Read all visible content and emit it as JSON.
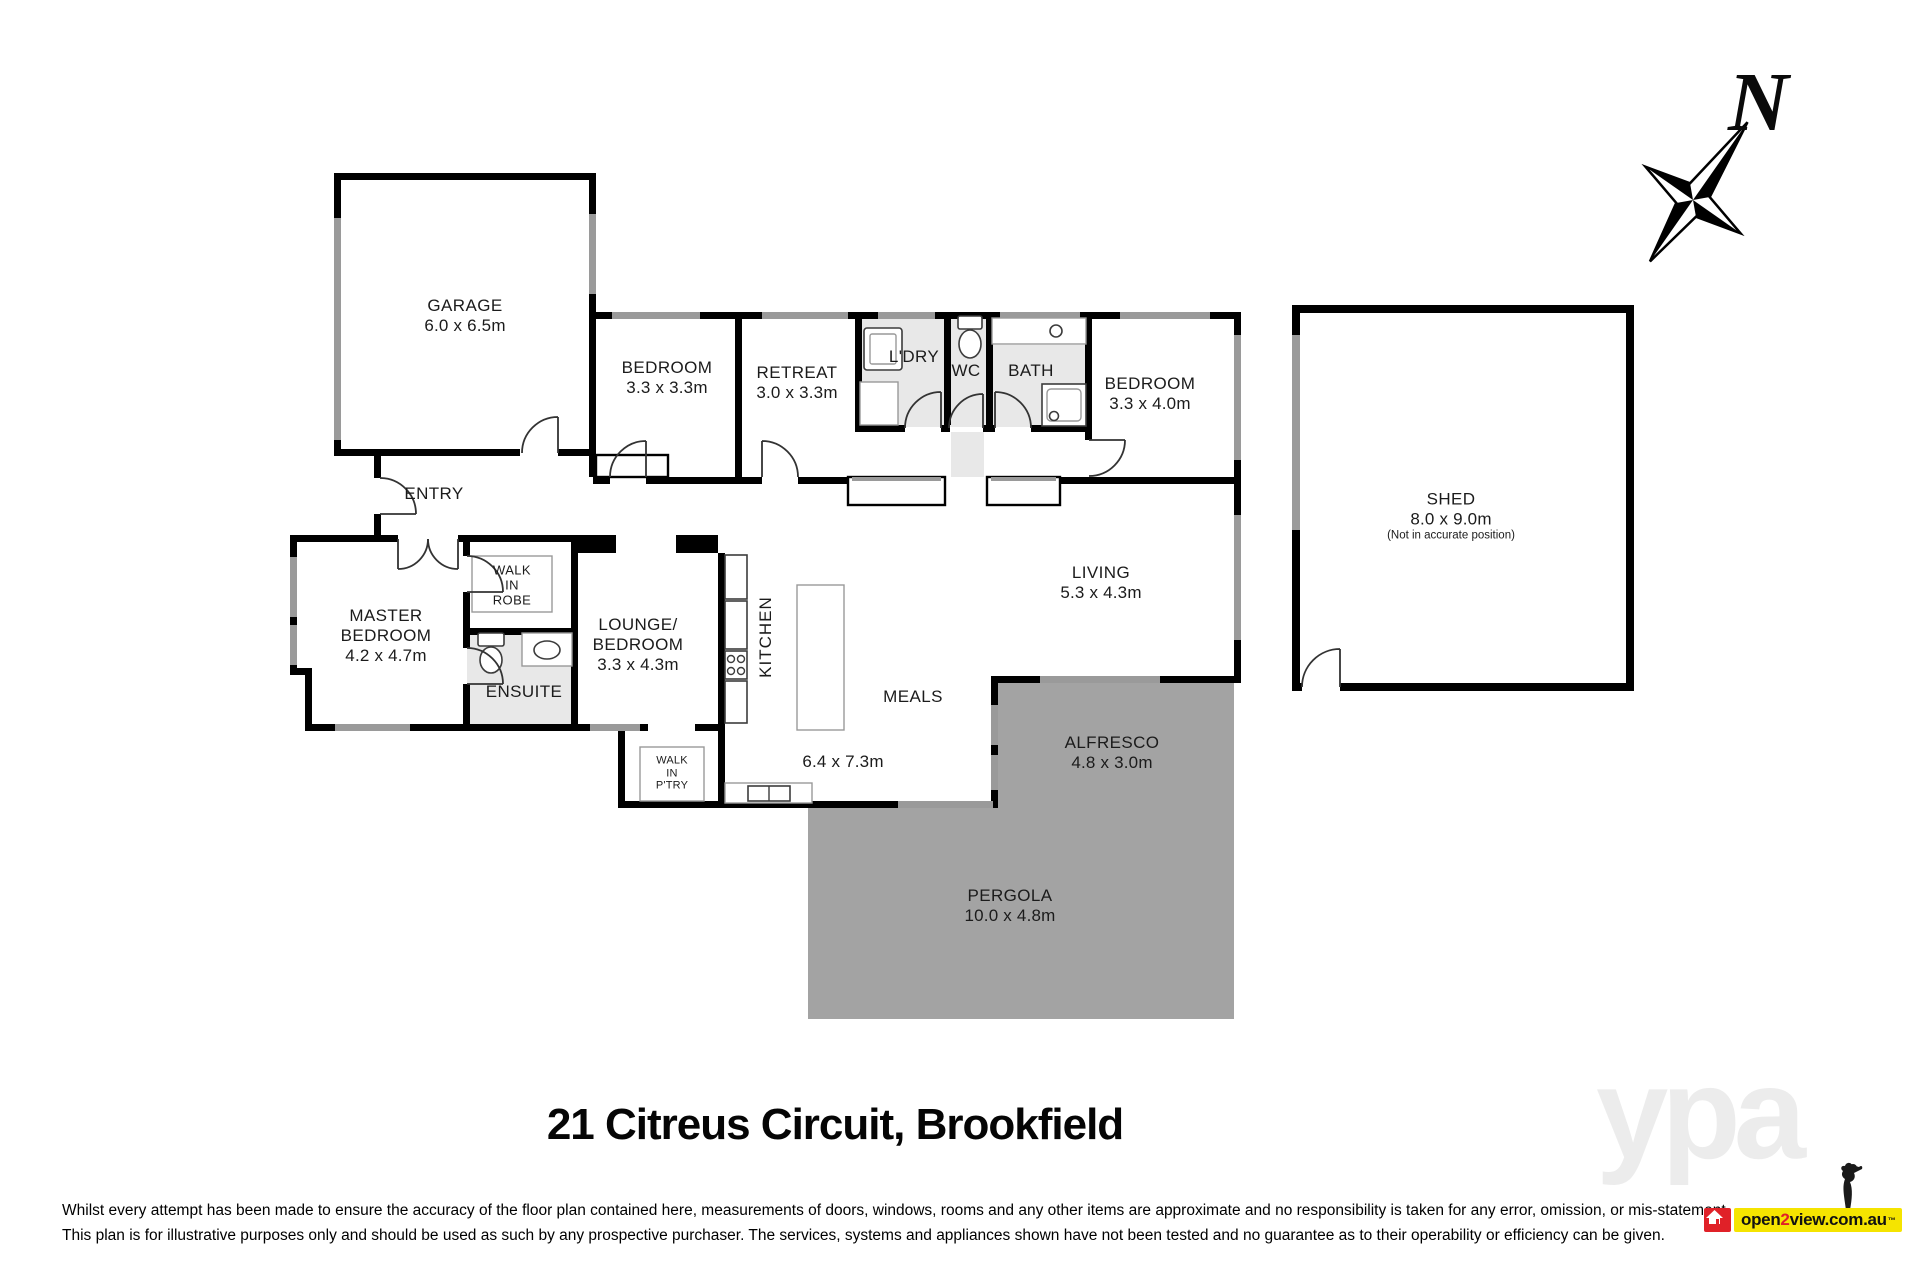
{
  "title": "21 Citreus Circuit, Brookfield",
  "compass": {
    "north_label": "N"
  },
  "rooms": {
    "garage": {
      "name": "GARAGE",
      "dims": "6.0 x 6.5m"
    },
    "bedroom_top": {
      "name": "BEDROOM",
      "dims": "3.3 x 3.3m"
    },
    "retreat": {
      "name": "RETREAT",
      "dims": "3.0 x 3.3m"
    },
    "laundry": {
      "name": "L'DRY"
    },
    "wc": {
      "name": "WC"
    },
    "bath": {
      "name": "BATH"
    },
    "bedroom_right": {
      "name": "BEDROOM",
      "dims": "3.3 x 4.0m"
    },
    "shed": {
      "name": "SHED",
      "dims": "8.0 x 9.0m",
      "note": "(Not in accurate position)"
    },
    "entry": {
      "name": "ENTRY"
    },
    "master_bedroom": {
      "name_line1": "MASTER",
      "name_line2": "BEDROOM",
      "dims": "4.2 x 4.7m"
    },
    "walk_in_robe": {
      "name_line1": "WALK",
      "name_line2": "IN",
      "name_line3": "ROBE"
    },
    "ensuite": {
      "name": "ENSUITE"
    },
    "lounge_bedroom": {
      "name_line1": "LOUNGE/",
      "name_line2": "BEDROOM",
      "dims": "3.3 x 4.3m"
    },
    "kitchen": {
      "name": "KITCHEN"
    },
    "living": {
      "name": "LIVING",
      "dims": "5.3 x 4.3m"
    },
    "meals": {
      "name": "MEALS"
    },
    "open_plan": {
      "dims": "6.4 x 7.3m"
    },
    "walk_in_pantry": {
      "name_line1": "WALK",
      "name_line2": "IN",
      "name_line3": "P'TRY"
    },
    "alfresco": {
      "name": "ALFRESCO",
      "dims": "4.8 x 3.0m"
    },
    "pergola": {
      "name": "PERGOLA",
      "dims": "10.0 x 4.8m"
    }
  },
  "footer": {
    "disclaimer_line1": "Whilst every attempt has been made to ensure the accuracy of the floor plan contained here, measurements of doors, windows, rooms and any other items are approximate and no responsibility is taken for any error, omission, or mis-statement.",
    "disclaimer_line2": "This plan is for illustrative purposes only and should be used as such by any prospective purchaser. The services, systems and appliances shown have not been tested and no guarantee as to their operability or efficiency can be given."
  },
  "watermark": "ypa",
  "logo": {
    "open": "open",
    "two": "2",
    "rest": "view.com.au",
    "tm": "™"
  },
  "colors": {
    "wall": "#000000",
    "window": "#9a9a9a",
    "wet_room_floor": "#e8e8e8",
    "outdoor_area": "#a3a3a3",
    "logo_yellow": "#f5e400",
    "logo_red": "#e02128"
  }
}
